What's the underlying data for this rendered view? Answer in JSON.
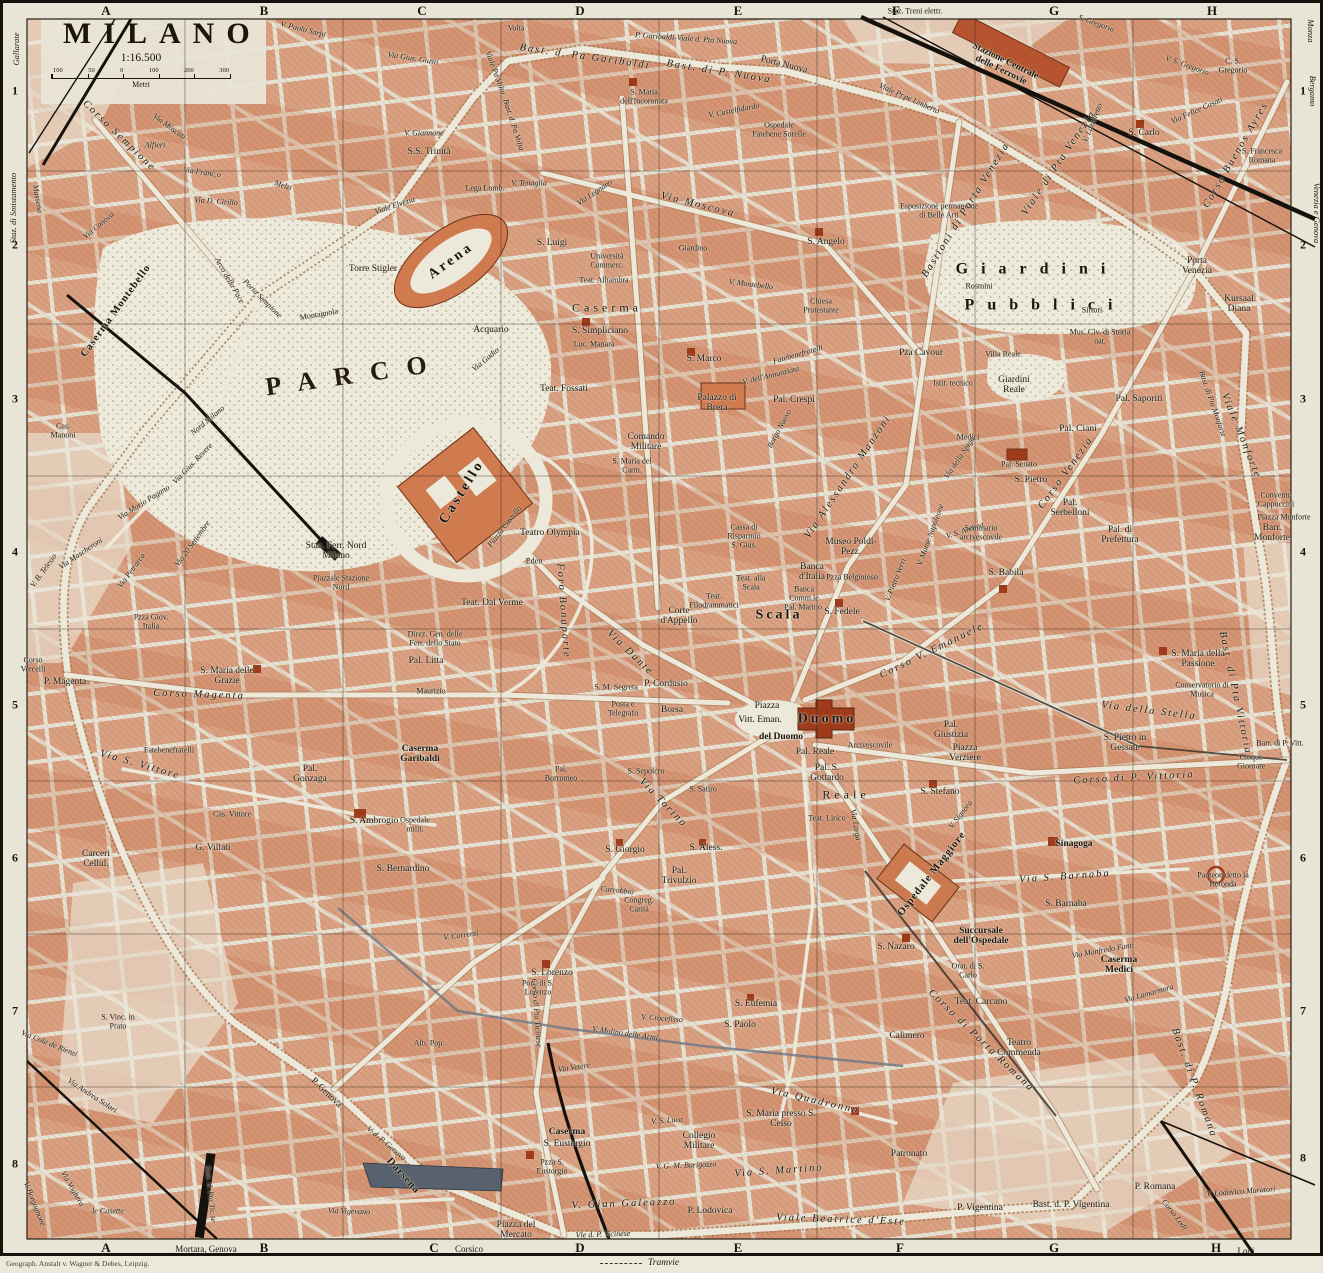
{
  "header": {
    "title": "MILANO",
    "scale": "1:16.500",
    "unit": "Metri",
    "scale_ticks": [
      "100",
      "50",
      "0",
      "100",
      "200",
      "300"
    ]
  },
  "grid": {
    "cols": [
      "A",
      "B",
      "C",
      "D",
      "E",
      "F",
      "G",
      "H"
    ],
    "rows": [
      "1",
      "2",
      "3",
      "4",
      "5",
      "6",
      "7",
      "8"
    ]
  },
  "edges": {
    "gallarate": "Gallarate",
    "smistamento": "Staz. di Smistamento",
    "monza": "Monza",
    "bergamo": "Bergamo",
    "venezia_genova": "Venezia e Genova",
    "mortara_genova": "Mortara, Genova",
    "corsico": "Corsico",
    "lodi": "Lodi"
  },
  "legend": {
    "tramvie": "Tramvie"
  },
  "credit": "Geograph. Anstalt v. Wagner & Debes, Leipzig.",
  "colors": {
    "paper": "#e7e3d4",
    "block_salmon": "#d9a081",
    "monument_red": "#9e3b1b",
    "castle": "#cf7a4f",
    "water": "#57626e",
    "railway": "#15110c"
  },
  "labels": [
    "PARCO",
    "Arena",
    "Torre Stigler",
    "Montagnola",
    "Acquario",
    "Castello",
    "Piazza Castello",
    "Teatro Olympia",
    "Eden",
    "Teat. Dal Verme",
    "Staz. Ferr. Nord Milano",
    "Piazzale Stazione Nord",
    "Arco della Pace",
    "Porta Sempione",
    "Corso Sempione",
    "Via Moscati",
    "Melzi",
    "Via Franc.o",
    "Via D. Cirillo",
    "Massena",
    "Via Canova",
    "Alfieri",
    "V. Giannone",
    "S.S. Trinità",
    "V. Paolo Sarpi",
    "Viale Elvezia",
    "Lega Lomb.",
    "Viale Pa Volta",
    "Bast. d. Pa Volta",
    "Volta",
    "Bast. d. Pa Garibaldi",
    "P. Garibaldi-Viale d. Pta Nuova",
    "Bast. di P. Nuova",
    "Porta Nuova",
    "S. Maria dell'Incoronata",
    "Ospedale Fatebene Sorelle",
    "Via Moscova",
    "S. Angelo",
    "V. Montebello",
    "Chiesa Protestante",
    "Caserma",
    "S. Simpliciano",
    "Luc. Manara",
    "Teat. Fossati",
    "S. Luigi",
    "Università Commerc.",
    "Teat. Alhambra",
    "S. Marco",
    "Fatebenefratelli",
    "V. dell'Annunziata",
    "Pal. Crespi",
    "Palazzo di Brera",
    "Borgo Nuovo",
    "Via Alessandro Manzoni",
    "Pza Cavour",
    "Istit. tecnico",
    "Villa Reale",
    "Giardini Reale",
    "Medici",
    "Pal. Senato",
    "Via della Spiga",
    "V. Monte Napoleone",
    "V. S. Andrea",
    "V. Pietro Verri",
    "Seminario arcivescovile",
    "Museo Poldi-Pezz.",
    "Banca d'Italia",
    "Pzza Belgioioso",
    "Banca Comm.le",
    "Cassa di Risparmio",
    "S. Gius.",
    "Teat. alla Scala",
    "Teat. Filodrammatici",
    "Scala",
    "Pal. Marino",
    "S. Fedele",
    "Corso V. Emanuele",
    "S. Babila",
    "Corso Venezia",
    "S. Pietro",
    "Pal. Serbelloni",
    "Pal. di Prefettura",
    "Pal. Ciani",
    "Pal. Saporiti",
    "Mus. Civ. di Storia nat.",
    "Giardini",
    "Pubblici",
    "Rosmini",
    "Sirtori",
    "Esposizione permanente di Belle Arti",
    "Porta Venezia",
    "Kursaal Diana",
    "Corso Buenos Ayres",
    "S. Carlo",
    "V. S. Gregorio",
    "C. S. Gregorio",
    "S. Francesca Romana",
    "Via Felice Casati",
    "V. Lazzaretto",
    "Viale di Pta Venezia",
    "Bastioni di Porta Venezia",
    "Viale Pr.pe Umberto",
    "Stazione Centrale delle Ferrovie",
    "Staz. Treni elettr.",
    "S. Gregorio",
    "Comando Militare",
    "S. Maria del Carm.",
    "Via Dante",
    "Foro Bonaparte",
    "P. Cordusio",
    "Borsa",
    "S. M. Segreta",
    "Posta e Telegrafo",
    "Corte d'Appello",
    "Via Torino",
    "Piazza",
    "Vitt. Eman.",
    "del Duomo",
    "Duomo",
    "Pal. Reale",
    "Arcivescovile",
    "Pal. Giustizia",
    "Piazza Verziere",
    "Pal. S. Gottardo",
    "Reale",
    "Via Larga",
    "S. Stefano",
    "V. Signora",
    "S. Giorgio",
    "S. Aless.",
    "Pal. Trivulzio",
    "Carrobbio",
    "Congreg. Carità",
    "S. Lorenzo",
    "Port. di S. Lorenzo",
    "S. Eufemia",
    "S. Paolo",
    "V. Crocefisso",
    "Corso di Porta Romana",
    "Ospedale Maggiore",
    "Via S. Barnaba",
    "S. Barnaba",
    "Sinagoga",
    "Panteon detto la Rotonda",
    "Succursale dell'Ospedale",
    "S. Nazaro",
    "Orat. di S. Carlo",
    "Teat. Carcano",
    "Calimero",
    "Teatro Commenda",
    "Caserma Medici",
    "Via Manfredo Fanti",
    "Via Lamarmora",
    "Bast. di P. Romana",
    "Via Quadronno",
    "S. Maria presso S. Celso",
    "Patronato",
    "P. Vigentina",
    "Bast. d. P. Vigentina",
    "P. Romana",
    "V. Lodovico Muratori",
    "Corso Lodi",
    "S. Maria della Passione",
    "Conservatorio di Musica",
    "Via della Stella",
    "S. Pietro in Gessate",
    "Corso di P. Vittoria",
    "Cinque Giornate",
    "Barr. di P. Vitt.",
    "Bast. di Pta Vittoria",
    "Viale Monforte",
    "Bast. di Pta Monforte",
    "Convento Cappuccini",
    "Piazza Monforte",
    "Barr. Monforte",
    "Caserma Garibaldi",
    "Pal. Gonzaga",
    "S. Ambrogio",
    "Ospedale milit.",
    "S. Bernardino",
    "S. Maria delle Grazie",
    "P. Magenta",
    "Corso Vercelli",
    "Corso Magenta",
    "Fatebenefratelli",
    "Via S. Vittore",
    "Pzza Giov. Italia",
    "Cas. Vittore",
    "G. Villati",
    "Carceri Cellul.",
    "Caserma Montebello",
    "Cas. Manoni",
    "Via Mario Pagano",
    "Via Gius. Revere",
    "Via 20 Settembre",
    "Via Mascheroni",
    "V. B. Telesio",
    "Via Petrarca",
    "Nord Milano",
    "Darsena",
    "P. Genova",
    "V. d. P. Genova",
    "Via Vigevano",
    "Via Andrea Solari",
    "Via Voghera",
    "le Casette",
    "V. Borgognone",
    "Via Cola de Rienzi",
    "Staz. d. Pta Tic.se",
    "Via Vetere",
    "V. S. Luca",
    "Collegio Militare",
    "V. G. M. Burigozzo",
    "Via S. Martino",
    "V. Gian Galeazzo",
    "P. Lodovica",
    "Viale Beatrice d'Este",
    "Piazza del Mercato",
    "Vle d. P. Ticinese",
    "Caserma",
    "S. Eustorgio",
    "Pzza S. Eustorgio",
    "Corso di Pta Ticinese",
    "Pal. Litta",
    "Maurizio",
    "Direz. Gen. delle Ferr. dello Stato",
    "Via Gius. Giusti",
    "Via Legnano",
    "V. Castelfidardo",
    "V. Tenaglia",
    "S. Vinc. in Prato",
    "S. Sepolcro",
    "S. Satiro",
    "Pal. Borromeo",
    "Giardino",
    "Via Gadio",
    "V. Molino delle Armi",
    "V. Correnti",
    "Alb. Pop.",
    "Teat. Lirico"
  ]
}
